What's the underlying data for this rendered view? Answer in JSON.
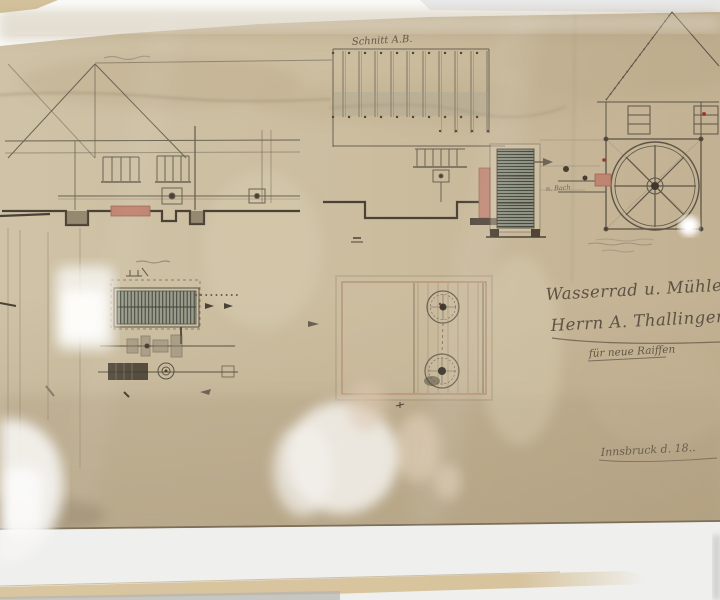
{
  "photo": {
    "description": "Framed historical watermill engineering drawing behind reflective glass",
    "colors": {
      "paper": "#cbbc9e",
      "ink": "#6a6254",
      "dark_ink": "#4a4237",
      "red_accent": "#bf8470",
      "grate_green": "#8f9182",
      "mat_white": "#eff0ee",
      "frame_beige": "#d9c6a0"
    }
  },
  "drawing": {
    "labels": {
      "center_section_title": "Schnitt A.B.",
      "sluice_note": "n. Bach"
    },
    "title_block": {
      "line1": "Wasserrad u. Mühlenanlage",
      "line2": "Herrn A. Thallinger",
      "line3": "für neue Raiffen",
      "signature": "Innsbruck d. 18.."
    }
  }
}
